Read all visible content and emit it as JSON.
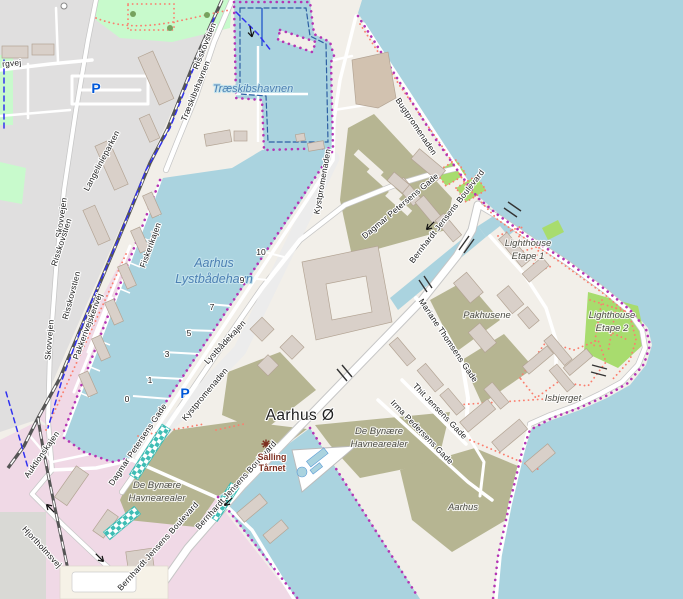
{
  "palette": {
    "water": "#aad3df",
    "land": "#f2efe9",
    "residential": "#e0dfdf",
    "industrial_pink": "#f0d9e6",
    "brownfield": "#b6b592",
    "park": "#c8facc",
    "bright_green": "#a8dc6e",
    "building": "#d9d0c9",
    "building_stroke": "#b3a494",
    "road": "#ffffff",
    "road_casing": "#c6c6c6",
    "railway": "#555555",
    "admin_boundary": "#b435b4",
    "footpath": "#fb7e6e",
    "cycleway": "#3232f0",
    "harbour_line": "#2e5fa3",
    "water_label": "#4d80b3",
    "area_label": "#4c4c44",
    "poi_brown": "#7d2f20",
    "parking_blue": "#0057d8",
    "construction_teal": "#3fbdb5"
  },
  "place_labels": {
    "aarhus_o": "Aarhus Ø"
  },
  "water_labels": {
    "traeskibshavnen": "Træskibshavnen",
    "lystbaadehavn_line1": "Aarhus",
    "lystbaadehavn_line2": "Lystbådehavn"
  },
  "area_labels": {
    "lighthouse1_line1": "Lighthouse",
    "lighthouse1_line2": "Etape 1",
    "lighthouse2_line1": "Lighthouse",
    "lighthouse2_line2": "Etape 2",
    "pakhusene": "Pakhusene",
    "isbjerget": "Isbjerget",
    "de_bynaere_line1": "De Bynære",
    "de_bynaere_line2": "Havnearealer",
    "aarhus_building": "Aarhus"
  },
  "street_labels": {
    "skovvejen": "Skovvejen",
    "risskovstien": "Risskovstien",
    "langelinieparken": "Langelinieparken",
    "traeskibshavnen": "Træskibshavnen",
    "rgvej": "rgvej",
    "fiskerikajen": "Fiskerikajen",
    "fiskerivej": "Fiskerivej",
    "pakkerivej": "Pakkerivej",
    "auktionskajen": "Auktionskajen",
    "hjortholmsvej": "Hjortholmsvej",
    "kystpromenaden": "Kystpromenaden",
    "lystbaadekajen": "Lystbådekajen",
    "bugtpromenaden": "Bugtpromenaden",
    "dagmar_petersens_gade": "Dagmar Petersens Gade",
    "bernhardt_jensens_boulevard": "Bernhardt Jensens Boulevard",
    "mariane_thomsens_gade": "Mariane Thomsens Gade",
    "thit_jensens_gade": "Thit Jensens Gade",
    "irma_pedersens_gade": "Irma Pedersens Gade"
  },
  "poi_labels": {
    "salling_line1": "Salling",
    "salling_line2": "Tårnet",
    "parking": "P"
  },
  "pier_numbers": {
    "n0": "0",
    "n1": "1",
    "n3": "3",
    "n5": "5",
    "n7": "7",
    "n9": "9",
    "n10": "10"
  }
}
